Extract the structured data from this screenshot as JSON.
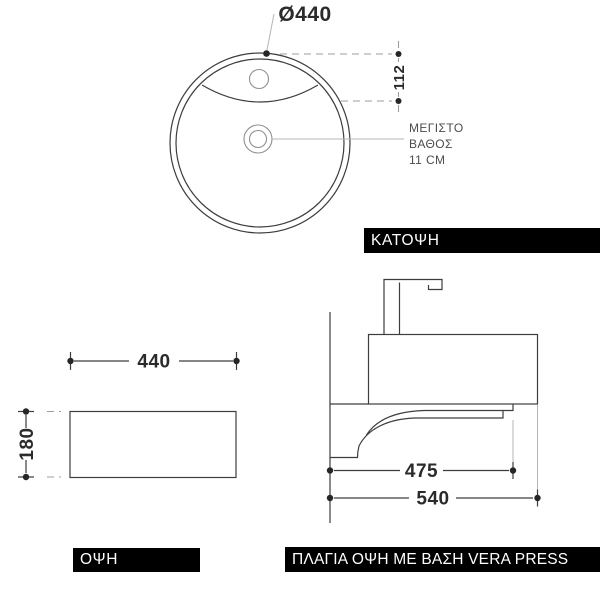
{
  "top_view": {
    "caption": "ΚΑΤΟΨΗ",
    "diameter_label": "Ø440",
    "vertical_dim": "112",
    "note_lines": [
      "ΜΕΓΙΣΤΟ",
      "ΒΑΘΟΣ",
      "11 CM"
    ]
  },
  "front_view": {
    "caption": "ΟΨΗ",
    "width_dim": "440",
    "height_dim": "180"
  },
  "side_view": {
    "caption": "ΠΛΑΓΙΑ ΟΨΗ ΜΕ ΒΑΣΗ VERA PRESS",
    "shelf_depth_dim": "475",
    "total_depth_dim": "540"
  },
  "colors": {
    "line": "#3d3d3d",
    "light_line": "#b5b5b5",
    "dashed_line": "#9c9c9c",
    "dim_text": "#2b2b2b",
    "note_text": "#4c4c4c",
    "caption_bg": "#000000",
    "caption_fg": "#ffffff"
  }
}
